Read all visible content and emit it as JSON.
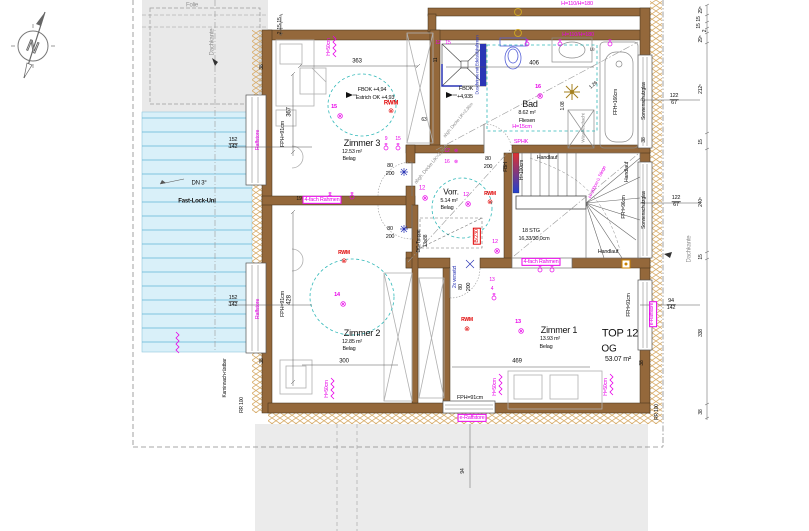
{
  "compass": {
    "n": "N"
  },
  "icons": {
    "light": "⊗"
  },
  "site": {
    "folie": "Folie",
    "dachkante": "Dachkante",
    "dn3": "DN 3°",
    "fastlock": "Fast-Lock-Uni",
    "rr100": "RR 100",
    "kamin_l1": "Kamin",
    "kamin_l2": "nach-",
    "kamin_l3": "rüstbar"
  },
  "unit": {
    "top": "TOP 12",
    "floor": "OG",
    "area": "53.07 m²"
  },
  "rooms": {
    "zimmer3": {
      "name": "Zimmer 3",
      "area": "12.53 m²",
      "finish": "Belag",
      "light": "15",
      "fbok": "FBOK +4,94",
      "estrich": "Estrich OK +4,93"
    },
    "zimmer2": {
      "name": "Zimmer 2",
      "area": "12.85 m²",
      "finish": "Belag",
      "light": "14"
    },
    "zimmer1": {
      "name": "Zimmer 1",
      "area": "13.93 m²",
      "finish": "Belag",
      "light": "13"
    },
    "bad": {
      "name": "Bad",
      "area": "8.62 m²",
      "finish": "Fliesen",
      "light": "16",
      "fbok": "FBOK",
      "fbok_val": "+4,935",
      "ceiling": "abgh. Decke UK=2,36m",
      "laundry": "Wäscheschacht",
      "vent": "Lü",
      "shower_note": "Duschrinne mit Edelstahlrahmen",
      "h15": "H=15cm",
      "sphk": "SPHK"
    },
    "vorr": {
      "name": "Vorr.",
      "area": "5.14 m²",
      "finish": "Belag",
      "light": "12",
      "ceiling": "abgh. Decke UK=2,36m",
      "treppe_l1": "DG-Treppe",
      "treppe_l2": "13x88",
      "hatch": "B/230",
      "versetzt": "2x versetzt"
    }
  },
  "stairs": {
    "stg": "18 STG",
    "step": "16,33/30,0cm",
    "handlauf": "Handlauf",
    "fbh": "FBH",
    "h100": "H=100cm",
    "h200": "H=200cm ü. Stiege",
    "ffh96": "FFH=96cm"
  },
  "windows": {
    "raffstore": "Raffstore",
    "e_raffstore": "e-Raffstore",
    "sonnenschutzglas": "Sonnenschutzglas",
    "fph91": "FPH=91cm",
    "ffh91": "FFH=91cm",
    "ffh166": "FFH=166cm",
    "h50": "H=50cm",
    "h110": "H=110/H=180",
    "rahmen": "4-fach Rahmen"
  },
  "safety": {
    "rwm": "RWM"
  },
  "tags": {
    "t9": "9",
    "t12": "12",
    "t13": "13",
    "t15": "15",
    "t16": "16",
    "t4": "4"
  },
  "dims": {
    "d363": "363",
    "d367": "367",
    "d63": "63",
    "d11": "11",
    "d406": "406",
    "d108": "1.08",
    "d126": "1.26",
    "d428": "428",
    "d300": "300",
    "d469": "469",
    "door_w": "80",
    "door_h": "200",
    "d122": "122",
    "d67": "67",
    "d94": "94",
    "d142": "142",
    "d152": "152",
    "d338": "338",
    "d212": "212⁵",
    "d240": "240⁵",
    "d29": "29⁵",
    "d15": "15",
    "d2": "2",
    "d38": "38",
    "d19": "19"
  },
  "colors": {
    "wall": "#94683b",
    "hatch": "#d8ae6e",
    "terrace": "#d9f0f9",
    "magenta": "#e800e8",
    "red": "#e00000",
    "blue": "#2a35b5",
    "teal": "#2fb8b8",
    "gold": "#c9a227"
  }
}
